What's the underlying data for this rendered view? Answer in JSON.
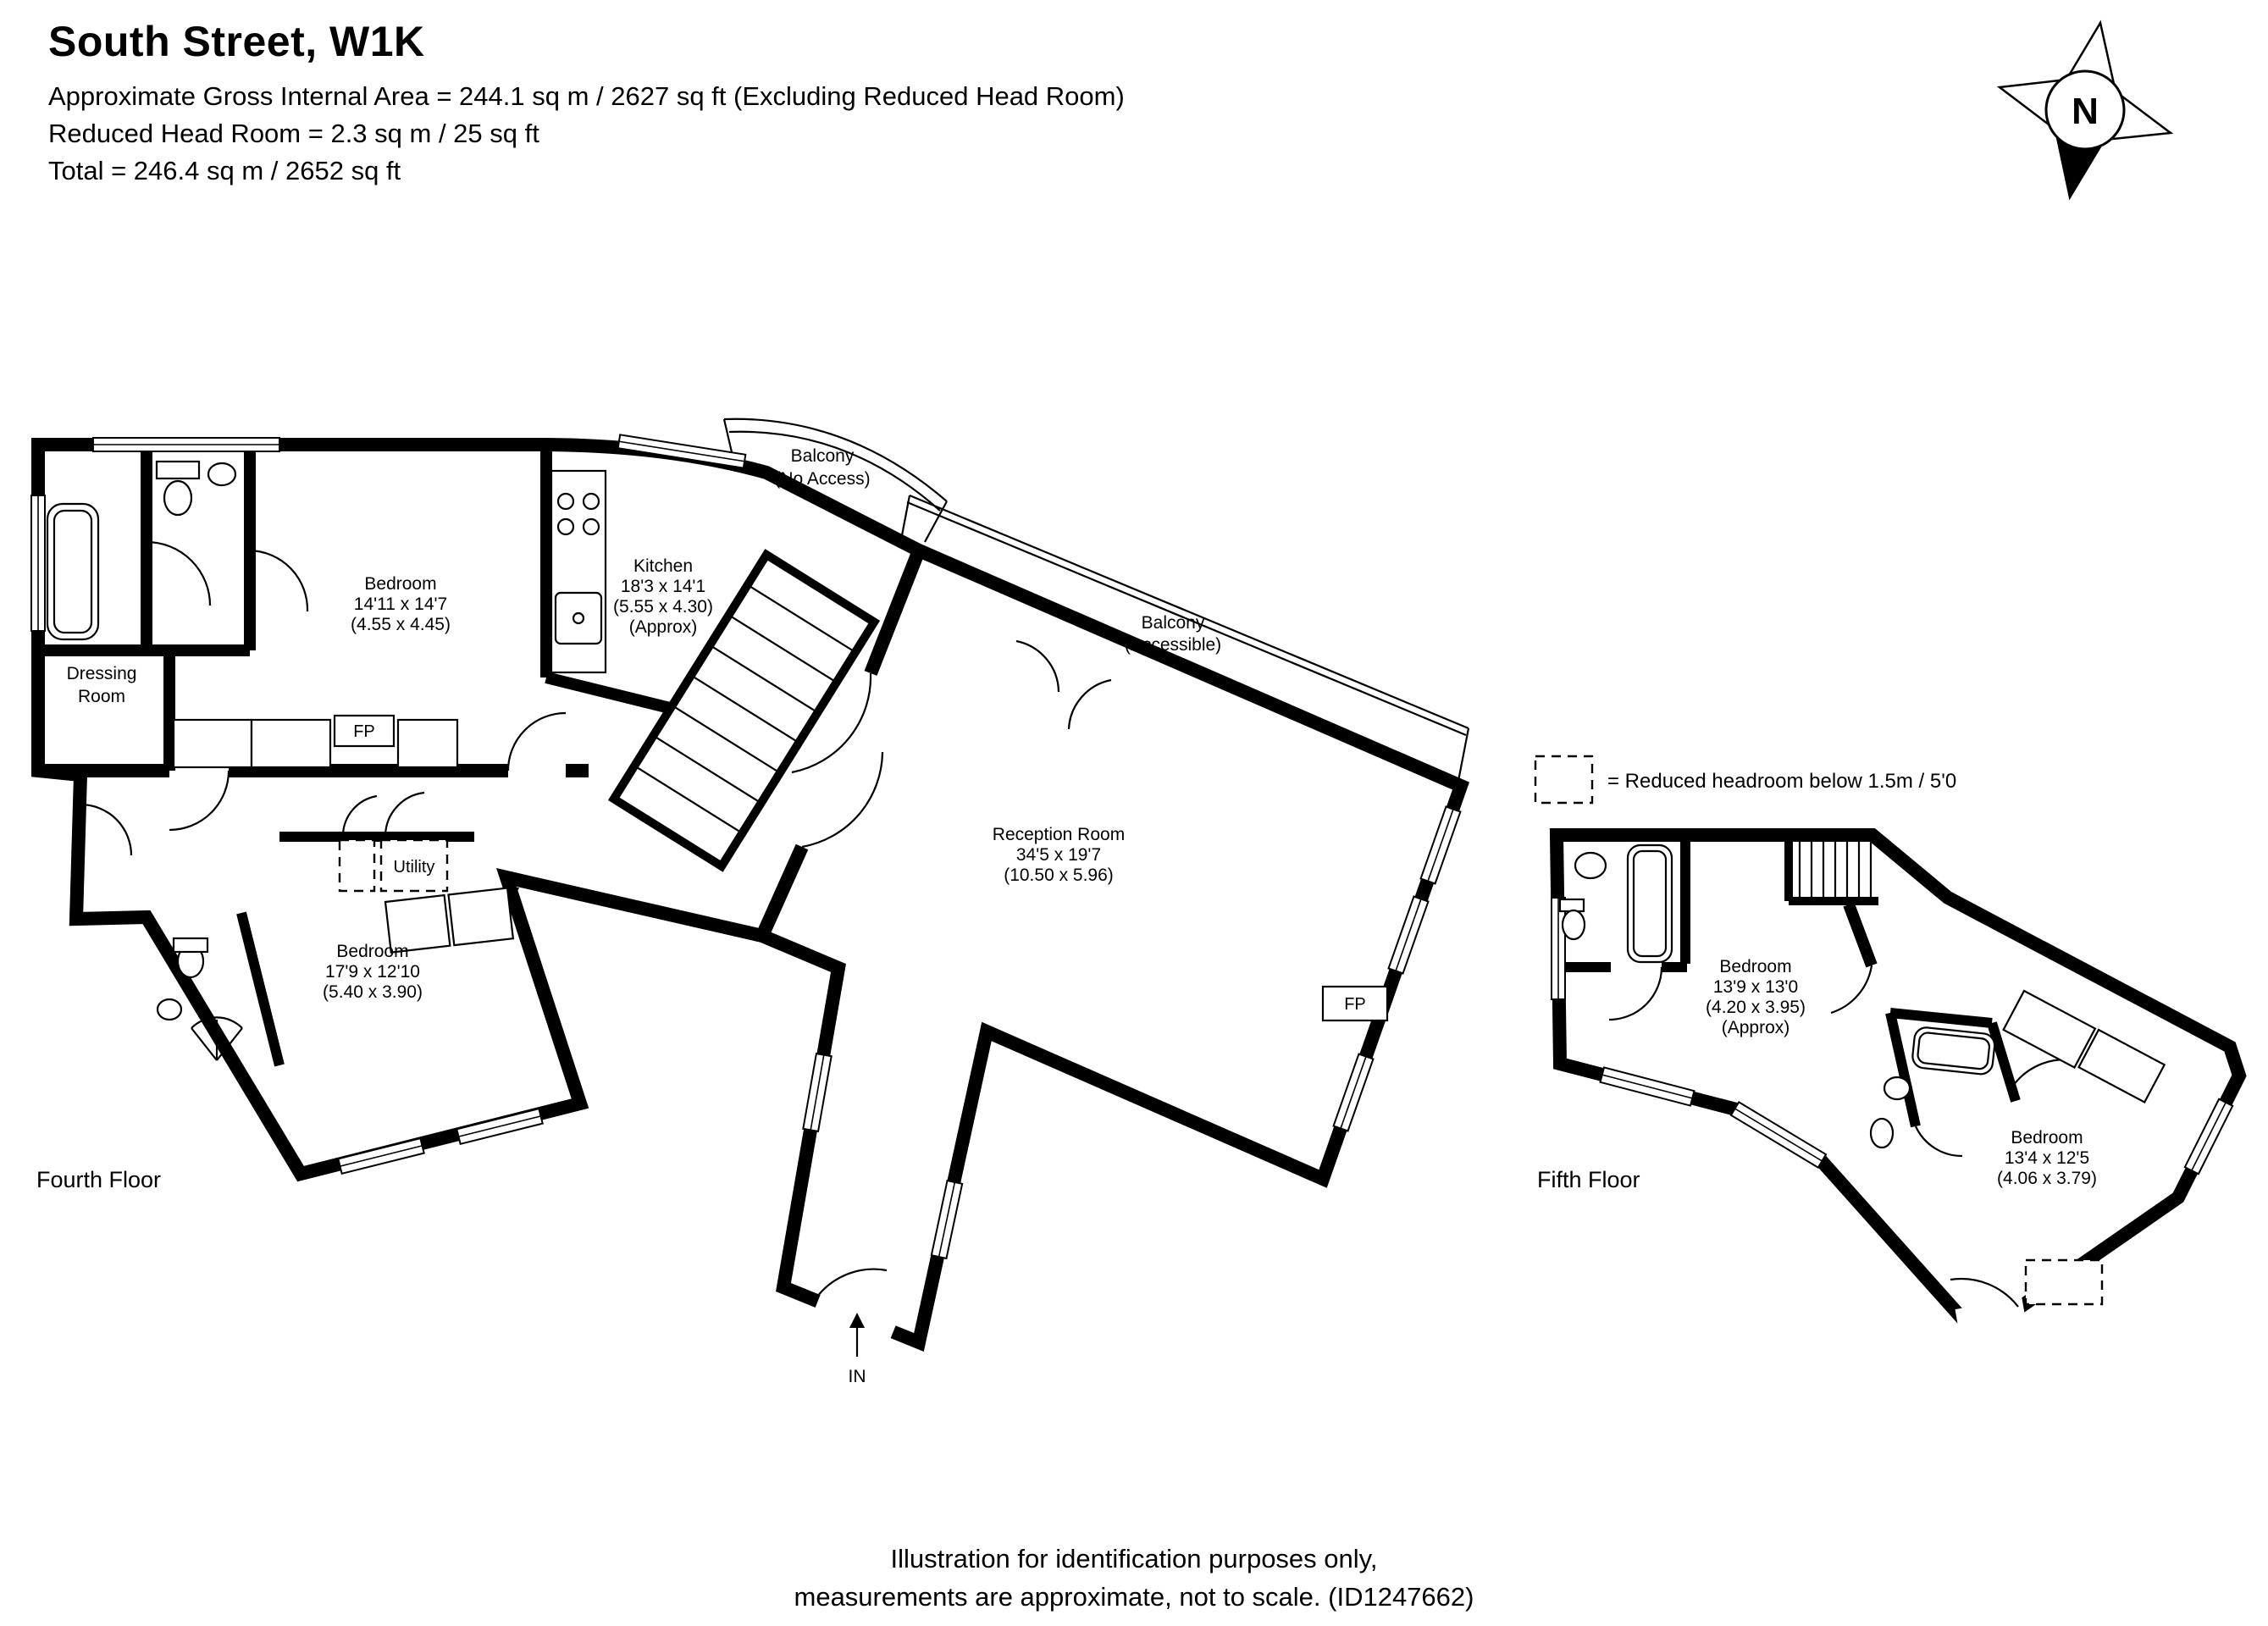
{
  "header": {
    "title": "South Street, W1K",
    "area_line": "Approximate Gross Internal Area = 244.1 sq m / 2627 sq ft (Excluding Reduced Head Room)",
    "reduced_line": "Reduced Head Room = 2.3 sq m / 25 sq ft",
    "total_line": "Total = 246.4 sq m / 2652 sq ft"
  },
  "compass": {
    "label": "N"
  },
  "legend": {
    "label": "= Reduced headroom below 1.5m / 5'0"
  },
  "fourth_floor": {
    "label": "Fourth Floor",
    "balcony_no_access": {
      "line1": "Balcony",
      "line2": "(No Access)"
    },
    "balcony_accessible": {
      "line1": "Balcony",
      "line2": "(Accessible)"
    },
    "kitchen": {
      "name": "Kitchen",
      "size_imperial": "18'3 x 14'1",
      "size_metric": "(5.55 x 4.30)",
      "note": "(Approx)"
    },
    "bedroom_front": {
      "name": "Bedroom",
      "size_imperial": "14'11 x 14'7",
      "size_metric": "(4.55 x 4.45)"
    },
    "dressing_room": {
      "line1": "Dressing",
      "line2": "Room"
    },
    "reception": {
      "name": "Reception Room",
      "size_imperial": "34'5 x 19'7",
      "size_metric": "(10.50 x 5.96)"
    },
    "utility": {
      "name": "Utility"
    },
    "bedroom_rear": {
      "name": "Bedroom",
      "size_imperial": "17'9 x 12'10",
      "size_metric": "(5.40 x 3.90)"
    },
    "fireplace_bedroom": "FP",
    "fireplace_reception": "FP",
    "entrance": "IN"
  },
  "fifth_floor": {
    "label": "Fifth Floor",
    "bedroom_front": {
      "name": "Bedroom",
      "size_imperial": "13'9 x 13'0",
      "size_metric": "(4.20 x 3.95)",
      "note": "(Approx)"
    },
    "bedroom_rear": {
      "name": "Bedroom",
      "size_imperial": "13'4 x 12'5",
      "size_metric": "(4.06 x 3.79)"
    }
  },
  "footer": {
    "line1": "Illustration for identification purposes only,",
    "line2": "measurements are approximate, not to scale. (ID1247662)"
  },
  "colors": {
    "walls": "#000000",
    "background": "#ffffff"
  }
}
